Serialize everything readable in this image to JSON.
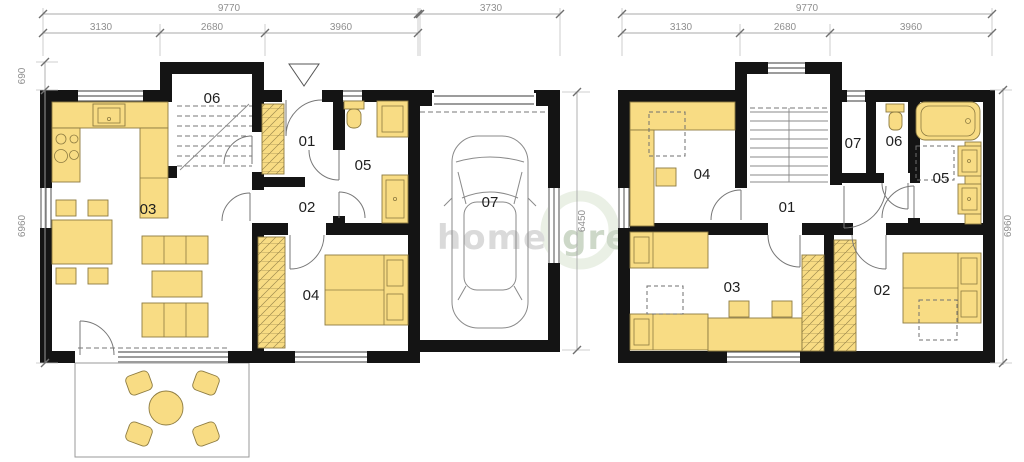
{
  "watermark": {
    "brand_left": "home-",
    "brand_right": "green",
    "registered": "®"
  },
  "colors": {
    "wall": "#141414",
    "furniture_fill": "#F8DC84",
    "furniture_stroke": "#8d7b41",
    "dimension_text": "#8f8f8f",
    "room_label": "#1f1f1f",
    "watermark_gray": "#d7d7d7",
    "watermark_green": "#c8d4c3",
    "watermark_ring": "#cbdcc2"
  },
  "ground_floor": {
    "dims": {
      "total_width": "9770",
      "segment_left": "3130",
      "segment_mid": "2680",
      "segment_right": "3960",
      "garage_width": "3730",
      "porch_depth": "690",
      "body_height": "6960",
      "garage_depth": "6450"
    },
    "rooms": {
      "hall": "01",
      "corridor": "02",
      "living_room": "03",
      "bedroom": "04",
      "bathroom": "05",
      "stairs": "06",
      "garage": "07"
    }
  },
  "upper_floor": {
    "dims": {
      "total_width": "9770",
      "segment_left": "3130",
      "segment_mid": "2680",
      "segment_right": "3960",
      "body_height": "6960"
    },
    "rooms": {
      "landing": "01",
      "master_bedroom": "02",
      "kids_bedroom": "03",
      "guest_bedroom": "04",
      "bathroom": "05",
      "wc": "06",
      "closet": "07"
    }
  }
}
